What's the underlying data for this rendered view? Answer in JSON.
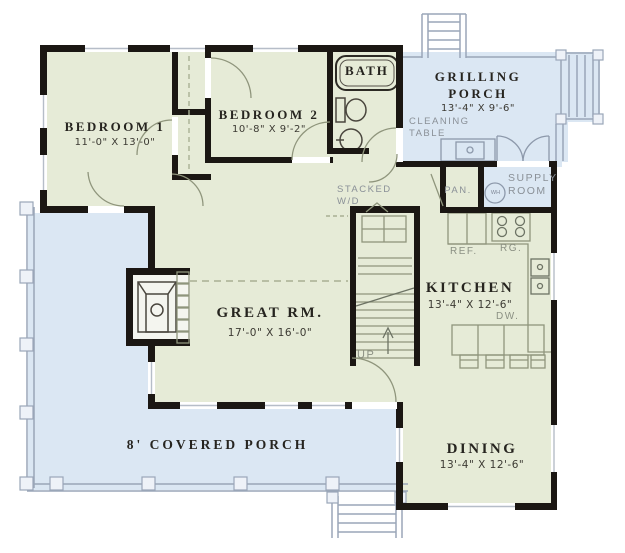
{
  "colors": {
    "room_green": "#e6ebd7",
    "porch_blue": "#dbe7f3",
    "wall": "#1b1713",
    "label_gray": "#8a9097",
    "text_dark": "#26241f"
  },
  "rooms": {
    "bedroom1": {
      "name": "BEDROOM 1",
      "dims": "11'-0\" X 13'-0\""
    },
    "bedroom2": {
      "name": "BEDROOM 2",
      "dims": "10'-8\" X 9'-2\""
    },
    "bath": {
      "name": "BATH"
    },
    "grilling_porch": {
      "name_line1": "GRILLING",
      "name_line2": "PORCH",
      "dims": "13'-4\" X 9'-6\""
    },
    "great_room": {
      "name": "GREAT RM.",
      "dims": "17'-0\" X 16'-0\""
    },
    "kitchen": {
      "name": "KITCHEN",
      "dims": "13'-4\" X 12'-6\""
    },
    "dining": {
      "name": "DINING",
      "dims": "13'-4\" X 12'-6\""
    },
    "covered_porch": {
      "name": "8' COVERED PORCH"
    },
    "supply_room": {
      "line1": "SUPPLY",
      "line2": "ROOM"
    }
  },
  "labels": {
    "cleaning_table_line1": "CLEANING",
    "cleaning_table_line2": "TABLE",
    "pantry": "PAN.",
    "stacked_line1": "STACKED",
    "stacked_line2": "W/D",
    "refrigerator": "REF.",
    "range": "RG.",
    "dishwasher": "DW.",
    "stairs_up": "UP",
    "water_heater": "WH"
  }
}
